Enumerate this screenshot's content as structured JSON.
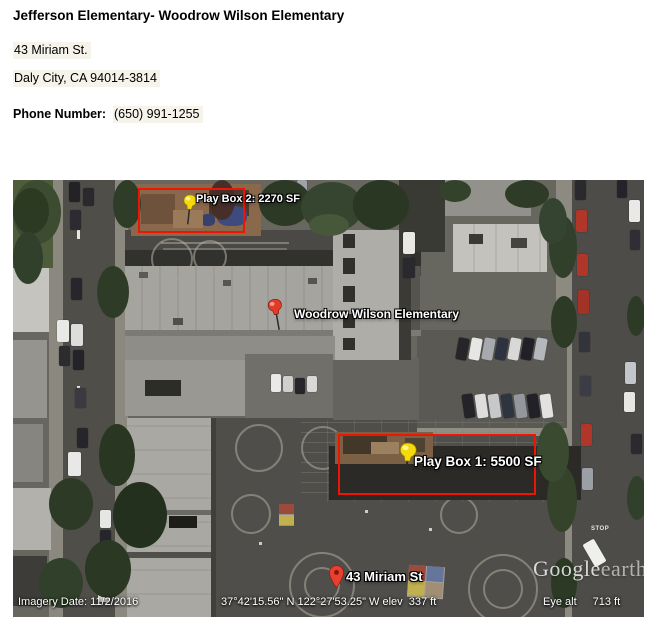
{
  "header": {
    "title": "Jefferson Elementary- Woodrow Wilson Elementary",
    "address_line1": "43 Miriam St.",
    "address_line2": "Daly City, CA 94014-3814",
    "phone_label": "Phone Number:",
    "phone_value": "(650) 991-1255"
  },
  "map": {
    "placemarks": {
      "play_box_2": {
        "label": "Play Box 2: 2270 SF",
        "pin": "yellow-pushpin"
      },
      "school": {
        "label": "Woodrow Wilson Elementary",
        "pin": "red-pushpin"
      },
      "play_box_1": {
        "label": "Play Box 1: 5500 SF",
        "pin": "yellow-pushpin"
      },
      "address_marker": {
        "label": "43 Miriam St",
        "pin": "red-map-marker"
      }
    },
    "status_bar": {
      "imagery_date": "Imagery Date: 11/2/2016",
      "coordinates": "37°42'15.56\" N 122°27'53.25\" W elev  337 ft",
      "eye_alt_label": "Eye alt",
      "eye_alt_value": "713 ft"
    },
    "watermark": {
      "brand": "Google",
      "product": "earth"
    },
    "road_marking": "STOP",
    "colors": {
      "annotation_red": "#ee1505",
      "pushpin_yellow": "#f5d90a",
      "pushpin_red": "#e23b28",
      "marker_red": "#e8402e"
    }
  }
}
